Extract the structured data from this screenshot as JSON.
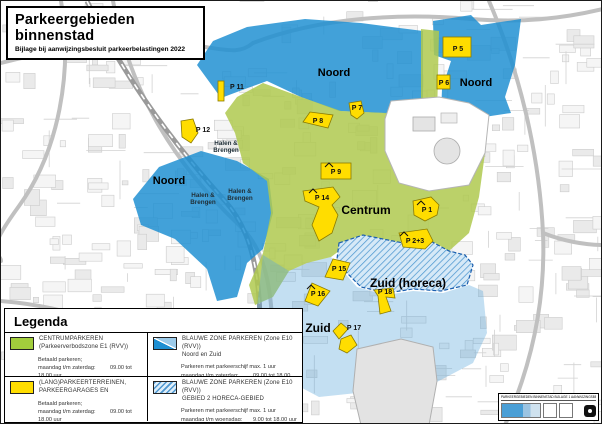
{
  "page": {
    "title": "Parkeergebieden binnenstad",
    "subtitle": "Bijlage bij aanwijzingsbesluit parkeerbelastingen 2022"
  },
  "legend": {
    "heading": "Legenda",
    "entries": [
      {
        "name_line1": "CENTRUMPARKEREN",
        "name_line2": "(Parkeerverbodszone E1 (RVV))",
        "rules": [
          {
            "l": "Betaald parkeren;",
            "v": ""
          },
          {
            "l": "maandag t/m zaterdag:",
            "v": "09.00 tot 18.00 uur"
          },
          {
            "l": "donderdag ook:",
            "v": "18.00 tot 21.00 uur"
          }
        ]
      },
      {
        "name_line1": "BLAUWE ZONE PARKEREN (Zone E10 (RVV))",
        "name_line2": "Noord en Zuid",
        "rules": [
          {
            "l": "Parkeren met parkeerschijf max. 1 uur",
            "v": ""
          },
          {
            "l": "maandag t/m zaterdag:",
            "v": "09.00 tot 18.00 uur"
          },
          {
            "l": "donderdag ook:",
            "v": "18.00 tot 21.00 uur"
          }
        ]
      },
      {
        "name_line1": "(LANG)PARKEERTERREINEN,",
        "name_line2": "PARKEERGARAGES EN",
        "rules": [
          {
            "l": "Betaald parkeren;",
            "v": ""
          },
          {
            "l": "maandag t/m zaterdag:",
            "v": "09.00 tot 18.00 uur"
          },
          {
            "l": "donderdag ook :",
            "v": "18.00 tot 21.00 uur"
          }
        ]
      },
      {
        "name_line1": "BLAUWE ZONE PARKEREN (Zone E10 (RVV))",
        "name_line2": "GEBIED 2 HORECA-GEBIED",
        "rules": [
          {
            "l": "Parkeren met parkeerschijf max. 1 uur",
            "v": ""
          },
          {
            "l": "maandag t/m woensdag:",
            "v": "9.00 tot 18.00 uur"
          },
          {
            "l": "daarna aansluitend van",
            "v": ""
          },
          {
            "l": "donderdag: 09.00 uur t/m zondag: 07.00 uur",
            "v": ""
          }
        ]
      }
    ]
  },
  "map": {
    "labels": {
      "noord": "Noord",
      "centrum": "Centrum",
      "zuid": "Zuid",
      "zuid_horeca": "Zuid (horeca)",
      "halen_line1": "Halen &",
      "halen_line2": "Brengen"
    },
    "parking": {
      "p1": "P 1",
      "p2_3": "P 2+3",
      "p5": "P 5",
      "p6": "P 6",
      "p7": "P 7",
      "p8": "P 8",
      "p9": "P 9",
      "p11": "P 11",
      "p12": "P 12",
      "p14": "P 14",
      "p15": "P 15",
      "p16": "P 16",
      "p17": "P 17",
      "p18": "P 18"
    }
  },
  "attribution": {
    "line": "PARKEERGEBIEDEN BINNENSTAD  BIJLAGE 1 AANWIJZINGSBESLUIT PARKEERBELASTINGEN 2022"
  },
  "colors": {
    "zone_blue": "#1E8FD2",
    "zone_green": "#AFC94F",
    "zone_yellow": "#FFDD00",
    "zone_zuid_pale": "#ADCDE6",
    "horeca_border": "#1B5FAF",
    "legend_green": "#A2CE3C"
  }
}
